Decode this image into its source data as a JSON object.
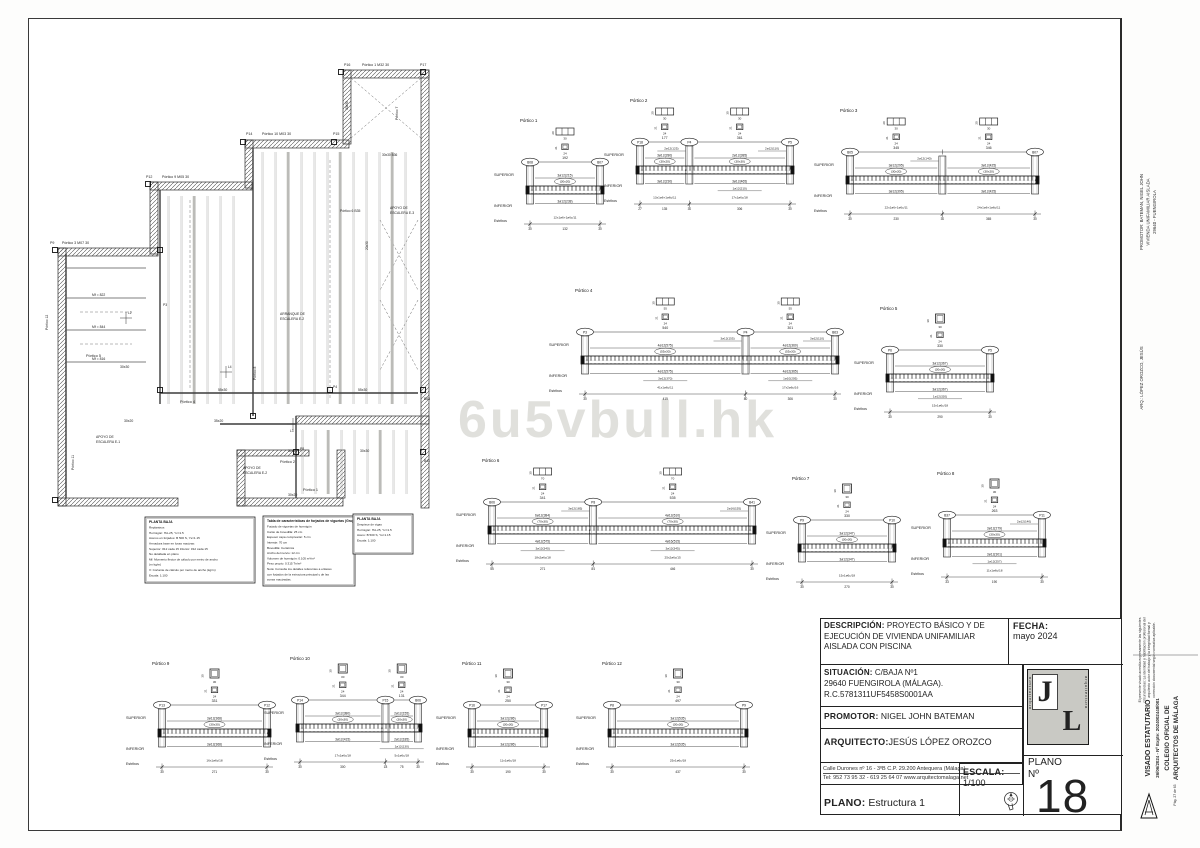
{
  "document": {
    "watermark": "6u5vbull.hk"
  },
  "title_block": {
    "descripcion_label": "DESCRIPCIÓN:",
    "descripcion": "PROYECTO BÁSICO Y DE EJECUCIÓN DE VIVIENDA UNIFAMILIAR AISLADA CON PISCINA",
    "fecha_label": "FECHA:",
    "fecha": "mayo  2024",
    "situacion_label": "SITUACIÓN:",
    "situacion_line1": "C/BAJA Nº1",
    "situacion_line2": "29640 FUENGIROLA (MÁLAGA).",
    "situacion_line3": "R.C.5781311UF5458S0001AA",
    "promotor_label": "PROMOTOR:",
    "promotor": "NIGEL JOHN BATEMAN",
    "arquitecto_label": "ARQUITECTO:",
    "arquitecto": "JESÚS LÓPEZ OROZCO",
    "address_line1": "Calle Durones nº 16 - 3ºB       C.P. 29.200       Antequera (Málaga)",
    "address_line2": "Tel: 952 73 95 32 - 619 25 64 07 www.arquitectomalaga.net",
    "plano_label": "PLANO:",
    "plano": "Estructura 1",
    "escala_label": "ESCALA:",
    "escala": "1/100",
    "plano_num_label1": "PLANO",
    "plano_num_label2": "Nº",
    "plano_num": "18",
    "logo_letters": [
      "J",
      "L"
    ],
    "logo_word": "arquitectura"
  },
  "right_margin": {
    "promotor_block": [
      "PROMOTOR:      BATEMAN, NIGEL JOHN",
      "VIVIENDA UNIFAMILIAR AISLADA",
      "29640 - FUENGIROLA"
    ],
    "arq_line": "ARQ.: LÓPEZ OROZCO, JESÚS",
    "visado_note": [
      "El presente visado acredita expresamente las siguientes",
      "circunstancias: La identidad y habilitación profesional del",
      "arquitecto autor del trabajo y la integridad formal y",
      "corrección documental según normativa aplicable."
    ],
    "visado_block": [
      "VISADO ESTATUTARIO",
      "26/06/2024 - Nº Expte: 2024002448/001",
      "COLEGIO OFICIAL DE",
      "ARQUITECTOS DE MÁLAGA"
    ],
    "page_label": "Pág. 27 de 63"
  },
  "legends": [
    {
      "x": 145,
      "y": 517,
      "w": 110,
      "h": 66,
      "title": "PLANTA BAJA",
      "lines": [
        "Replanteos",
        "Hormigón: HA-25, Yc=1.5",
        "Aceros en forjados: B 500 S, Ys=1.15",
        "Armadura base en losas macizas:",
        "Superior: #12 cada 15   Inferior: #12 cada 15",
        "No detallada en plano",
        "Mf: Momento flector de cálculo por metro de ancho",
        "(m·kg/m)",
        "V: Cortante de cálculo por metro de ancho (kg/m)",
        "Escala: 1:100"
      ]
    },
    {
      "x": 263,
      "y": 516,
      "w": 92,
      "h": 70,
      "title": "Tabla de características de forjados de viguetas (Grupo 1)",
      "lines": [
        "Forjado de viguetas de hormigón",
        "Canto de bovedilla: 25 cm",
        "Espesor capa compresión: 5 cm",
        "Intereje: 70 cm",
        "Bovedilla: Cerámica",
        "Ancho del nervio: 12 cm",
        "Volumen de hormigón: 0.105 m³/m²",
        "Peso propio: 0.315 Tn/m²",
        "Nota: Consulte los detalles referentes a enlaces",
        "con forjados de la estructura principal y de las",
        "zonas macizadas."
      ]
    },
    {
      "x": 353,
      "y": 514,
      "w": 60,
      "h": 40,
      "title": "PLANTA BAJA",
      "lines": [
        "Despiece de vigas",
        "Hormigón: HA-25, Yc=1.5",
        "Acero: B 500 S, Ys=1.15",
        "Escala: 1:100"
      ]
    }
  ],
  "plan": {
    "labels": [
      {
        "t": "P16",
        "x": 344,
        "y": 66,
        "s": 3.6
      },
      {
        "t": "Pórtico 1   M32  30",
        "x": 362,
        "y": 66,
        "s": 3.6
      },
      {
        "t": "P17",
        "x": 420,
        "y": 66,
        "s": 3.6
      },
      {
        "t": "P14",
        "x": 246,
        "y": 135,
        "s": 3.6
      },
      {
        "t": "Pórtico 10   M03  30",
        "x": 262,
        "y": 135,
        "s": 3.6
      },
      {
        "t": "P15",
        "x": 333,
        "y": 135,
        "s": 3.6
      },
      {
        "t": "P12",
        "x": 146,
        "y": 178,
        "s": 3.6
      },
      {
        "t": "Pórtico 9   M05  30",
        "x": 162,
        "y": 178,
        "s": 3.6
      },
      {
        "t": "P9",
        "x": 50,
        "y": 244,
        "s": 3.6
      },
      {
        "t": "Pórtico 3   M07  30",
        "x": 62,
        "y": 244,
        "s": 3.6
      },
      {
        "t": "Pórtico 5",
        "x": 86,
        "y": 357,
        "s": 3.8
      },
      {
        "t": "Pórtico 4",
        "x": 180,
        "y": 403,
        "s": 3.8
      },
      {
        "t": "Pórtico 2",
        "x": 280,
        "y": 463,
        "s": 3.8
      },
      {
        "t": "Pórtico 1",
        "x": 303,
        "y": 491,
        "s": 3.8
      },
      {
        "t": "Pórtico 6   B35",
        "x": 340,
        "y": 212,
        "s": 3.4
      },
      {
        "t": "APOYO DE",
        "x": 96,
        "y": 438,
        "s": 3.4
      },
      {
        "t": "ESCALERA E-1",
        "x": 96,
        "y": 443,
        "s": 3.4
      },
      {
        "t": "APOYO DE",
        "x": 243,
        "y": 469,
        "s": 3.4
      },
      {
        "t": "ESCALERA E-2",
        "x": 243,
        "y": 474,
        "s": 3.4
      },
      {
        "t": "ARRANQUE DE",
        "x": 280,
        "y": 315,
        "s": 3.4
      },
      {
        "t": "ESCALERA E-2",
        "x": 280,
        "y": 320,
        "s": 3.4
      },
      {
        "t": "APOYO DE",
        "x": 390,
        "y": 209,
        "s": 3.4
      },
      {
        "t": "ESCALERA E-3",
        "x": 390,
        "y": 214,
        "s": 3.4
      },
      {
        "t": "Mf = 822",
        "x": 92,
        "y": 296,
        "s": 3.4
      },
      {
        "t": "Mf = 844",
        "x": 92,
        "y": 328,
        "s": 3.4
      },
      {
        "t": "Mf = 816",
        "x": 92,
        "y": 360,
        "s": 3.4
      },
      {
        "t": "30x30",
        "x": 120,
        "y": 368,
        "s": 3.4
      },
      {
        "t": "55x30",
        "x": 218,
        "y": 391,
        "s": 3.4
      },
      {
        "t": "55x30",
        "x": 358,
        "y": 391,
        "s": 3.4
      },
      {
        "t": "30x20",
        "x": 124,
        "y": 422,
        "s": 3.4
      },
      {
        "t": "35x20",
        "x": 214,
        "y": 422,
        "s": 3.4
      },
      {
        "t": "30x20",
        "x": 288,
        "y": 452,
        "s": 3.4
      },
      {
        "t": "30x30",
        "x": 360,
        "y": 452,
        "s": 3.4
      },
      {
        "t": "30x20",
        "x": 288,
        "y": 496,
        "s": 3.4
      },
      {
        "t": "30x30 B36",
        "x": 382,
        "y": 156,
        "s": 3.2
      },
      {
        "t": "B63",
        "x": 424,
        "y": 400,
        "s": 3.4
      },
      {
        "t": "B41",
        "x": 424,
        "y": 462,
        "s": 3.4
      },
      {
        "t": "P3",
        "x": 163,
        "y": 306,
        "s": 3.4
      },
      {
        "t": "P4",
        "x": 333,
        "y": 388,
        "s": 3.4
      },
      {
        "t": "P8",
        "x": 300,
        "y": 450,
        "s": 3.4
      },
      {
        "t": "L2",
        "x": 128,
        "y": 314,
        "s": 3.2
      },
      {
        "t": "L4",
        "x": 228,
        "y": 368,
        "s": 3.2
      },
      {
        "t": "L3",
        "x": 290,
        "y": 432,
        "s": 3.2
      },
      {
        "t": "Pórtico 12",
        "x": 48,
        "y": 330,
        "s": 3.4,
        "r": -90
      },
      {
        "t": "Pórtico 11",
        "x": 74,
        "y": 470,
        "s": 3.4,
        "r": -90
      },
      {
        "t": "Pórtico 7",
        "x": 398,
        "y": 120,
        "s": 3.4,
        "r": -90
      },
      {
        "t": "Pórtico 8",
        "x": 256,
        "y": 380,
        "s": 3.4,
        "r": -90
      },
      {
        "t": "20x30",
        "x": 368,
        "y": 250,
        "s": 3.2,
        "r": -90
      },
      {
        "t": "30x30",
        "x": 348,
        "y": 110,
        "s": 3.2,
        "r": -90
      }
    ]
  },
  "porticos": [
    {
      "name": "Pórtico 1",
      "x": 530,
      "y": 112,
      "w": 70,
      "cols": [
        "B08",
        "B07"
      ],
      "spans": [
        "192"
      ],
      "sup": [
        "3ø12(215)"
      ],
      "sec": [
        "30x20"
      ],
      "inf": [
        "3ø12(238)"
      ],
      "est": [
        "12x1ø6+1ø6c/11"
      ],
      "dims": [
        "30",
        "132",
        "30"
      ],
      "csWide": true
    },
    {
      "name": "Pórtico 2",
      "x": 640,
      "y": 92,
      "w": 150,
      "cols": [
        "P18",
        "P4",
        "P5"
      ],
      "spans": [
        "177",
        "361"
      ],
      "sup": [
        "3ø12(280)",
        "2ø12(385)"
      ],
      "sup2": [
        "2ø12(125)",
        "2ø12(110)"
      ],
      "sec": [
        "30x20",
        "30x30"
      ],
      "inf": [
        "3ø12(230)",
        "3ø12(465)"
      ],
      "inf2": [
        null,
        "1ø12(210)"
      ],
      "est": [
        "13x1ø6+1ø6c/11",
        "17x1ø6c/18"
      ],
      "dims": [
        "27",
        "135",
        "30",
        "306",
        "30"
      ],
      "csWide": true
    },
    {
      "name": "Pórtico 3",
      "x": 850,
      "y": 102,
      "w": 185,
      "cols": [
        "B05",
        "",
        "B07"
      ],
      "spans": [
        "345",
        "346"
      ],
      "sup": [
        "3ø12(295)",
        "3ø12(425)"
      ],
      "sup2": [
        "2ø12(140)",
        null
      ],
      "sec": [
        "30x20",
        "30x20"
      ],
      "inf": [
        "3ø12(395)",
        "3ø12(425)"
      ],
      "est": [
        "22x1ø6+1ø6c/11",
        "24x1ø6+1ø6c/11"
      ],
      "dims": [
        "30",
        "230",
        "30",
        "365",
        "30"
      ],
      "csWide": true
    },
    {
      "name": "Pórtico 4",
      "x": 585,
      "y": 282,
      "w": 250,
      "cols": [
        "P3",
        "P4",
        "B63"
      ],
      "spans": [
        "540",
        "301"
      ],
      "sup": [
        "4ø12(575)",
        "4ø12(360)"
      ],
      "sup2": [
        "3ø12(155)",
        "3ø12(110)"
      ],
      "sec": [
        "55x30",
        "55x30"
      ],
      "inf": [
        "4ø12(575)",
        "4ø12(365)"
      ],
      "inf2": [
        "3ø12(370)",
        "1ø10(205)"
      ],
      "est": [
        "41x1ø6c/11",
        "17x2ø6c/16"
      ],
      "dims": [
        "30",
        "415",
        "80",
        "306",
        "30"
      ],
      "csWide": true
    },
    {
      "name": "Pórtico 5",
      "x": 890,
      "y": 300,
      "w": 100,
      "cols": [
        "P6",
        "P5"
      ],
      "spans": [
        "330"
      ],
      "sup": [
        "3ø12(367)"
      ],
      "sec": [
        "30x30"
      ],
      "inf": [
        "3ø12(367)"
      ],
      "inf2": [
        "1ø12(320)"
      ],
      "est": [
        "15x1ø6c/18"
      ],
      "dims": [
        "30",
        "290",
        "30"
      ],
      "csWide": false
    },
    {
      "name": "Pórtico 6",
      "x": 492,
      "y": 452,
      "w": 260,
      "cols": [
        "B06",
        "P8",
        "B41"
      ],
      "spans": [
        "341",
        "535"
      ],
      "sup": [
        "6ø12(384)",
        "4ø12(610)"
      ],
      "sup2": [
        "3ø12(185)",
        "2ø16(155)"
      ],
      "sec": [
        "70x30",
        "70x30"
      ],
      "inf": [
        "4ø12(575)",
        "4ø16(515)"
      ],
      "inf2": [
        "3ø12(340)",
        "3ø12(345)"
      ],
      "est": [
        "18x2ø6c/18",
        "25x2ø6c/15"
      ],
      "dims": [
        "55",
        "271",
        "84",
        "446",
        "30"
      ],
      "csWide": true
    },
    {
      "name": "Pórtico 7",
      "x": 802,
      "y": 470,
      "w": 90,
      "cols": [
        "P9",
        "P10"
      ],
      "spans": [
        "330"
      ],
      "sup": [
        "3ø12(347)"
      ],
      "sec": [
        "30x30"
      ],
      "inf": [
        "3ø12(347)"
      ],
      "est": [
        "15x1ø6c/18"
      ],
      "dims": [
        "30",
        "270",
        "30"
      ],
      "csWide": false
    },
    {
      "name": "Pórtico 8",
      "x": 947,
      "y": 465,
      "w": 95,
      "cols": [
        "B37",
        "P11"
      ],
      "spans": [
        "263"
      ],
      "sup": [
        "3ø12(279)"
      ],
      "sup2": [
        "2ø12(140)"
      ],
      "sec": [
        "30x30"
      ],
      "inf": [
        "3ø12(301)"
      ],
      "inf2": [
        "1ø12(257)"
      ],
      "est": [
        "11x1ø6c/18"
      ],
      "dims": [
        "33",
        "190",
        "30"
      ],
      "csWide": false
    },
    {
      "name": "Pórtico 9",
      "x": 162,
      "y": 655,
      "w": 105,
      "cols": [
        "P13",
        "P12"
      ],
      "spans": [
        "331"
      ],
      "sup": [
        "3ø12(368)"
      ],
      "sec": [
        "30x30"
      ],
      "inf": [
        "3ø12(368)"
      ],
      "est": [
        "16x1ø6c/18"
      ],
      "dims": [
        "30",
        "271",
        "30"
      ],
      "csWide": false
    },
    {
      "name": "Pórtico 10",
      "x": 300,
      "y": 650,
      "w": 118,
      "cols": [
        "P14",
        "P15",
        "B06"
      ],
      "spans": [
        "344",
        "131"
      ],
      "sup": [
        "3ø12(380)",
        "2ø12(155)"
      ],
      "sec": [
        "30x30",
        "30x30"
      ],
      "inf": [
        "3ø12(415)",
        "2ø12(185)"
      ],
      "inf2": [
        null,
        "1ø12(130)"
      ],
      "est": [
        "17x1ø6c/18",
        "5x1ø6c/18"
      ],
      "dims": [
        "30",
        "300",
        "18",
        "75",
        "30"
      ],
      "csWide": false
    },
    {
      "name": "Pórtico 11",
      "x": 472,
      "y": 655,
      "w": 72,
      "cols": [
        "P16",
        "P17"
      ],
      "spans": [
        "250"
      ],
      "sup": [
        "3ø12(286)"
      ],
      "sec": [
        "30x30"
      ],
      "inf": [
        "3ø12(286)"
      ],
      "est": [
        "11x1ø6c/18"
      ],
      "dims": [
        "30",
        "190",
        "30"
      ],
      "csWide": false
    },
    {
      "name": "Pórtico 12",
      "x": 612,
      "y": 655,
      "w": 132,
      "cols": [
        "P8",
        "P9"
      ],
      "spans": [
        "497"
      ],
      "sup": [
        "3ø12(535)"
      ],
      "sec": [
        "30x30"
      ],
      "inf": [
        "3ø12(535)"
      ],
      "est": [
        "25x1ø6c/18"
      ],
      "dims": [
        "30",
        "437",
        "30"
      ],
      "csWide": false
    }
  ]
}
